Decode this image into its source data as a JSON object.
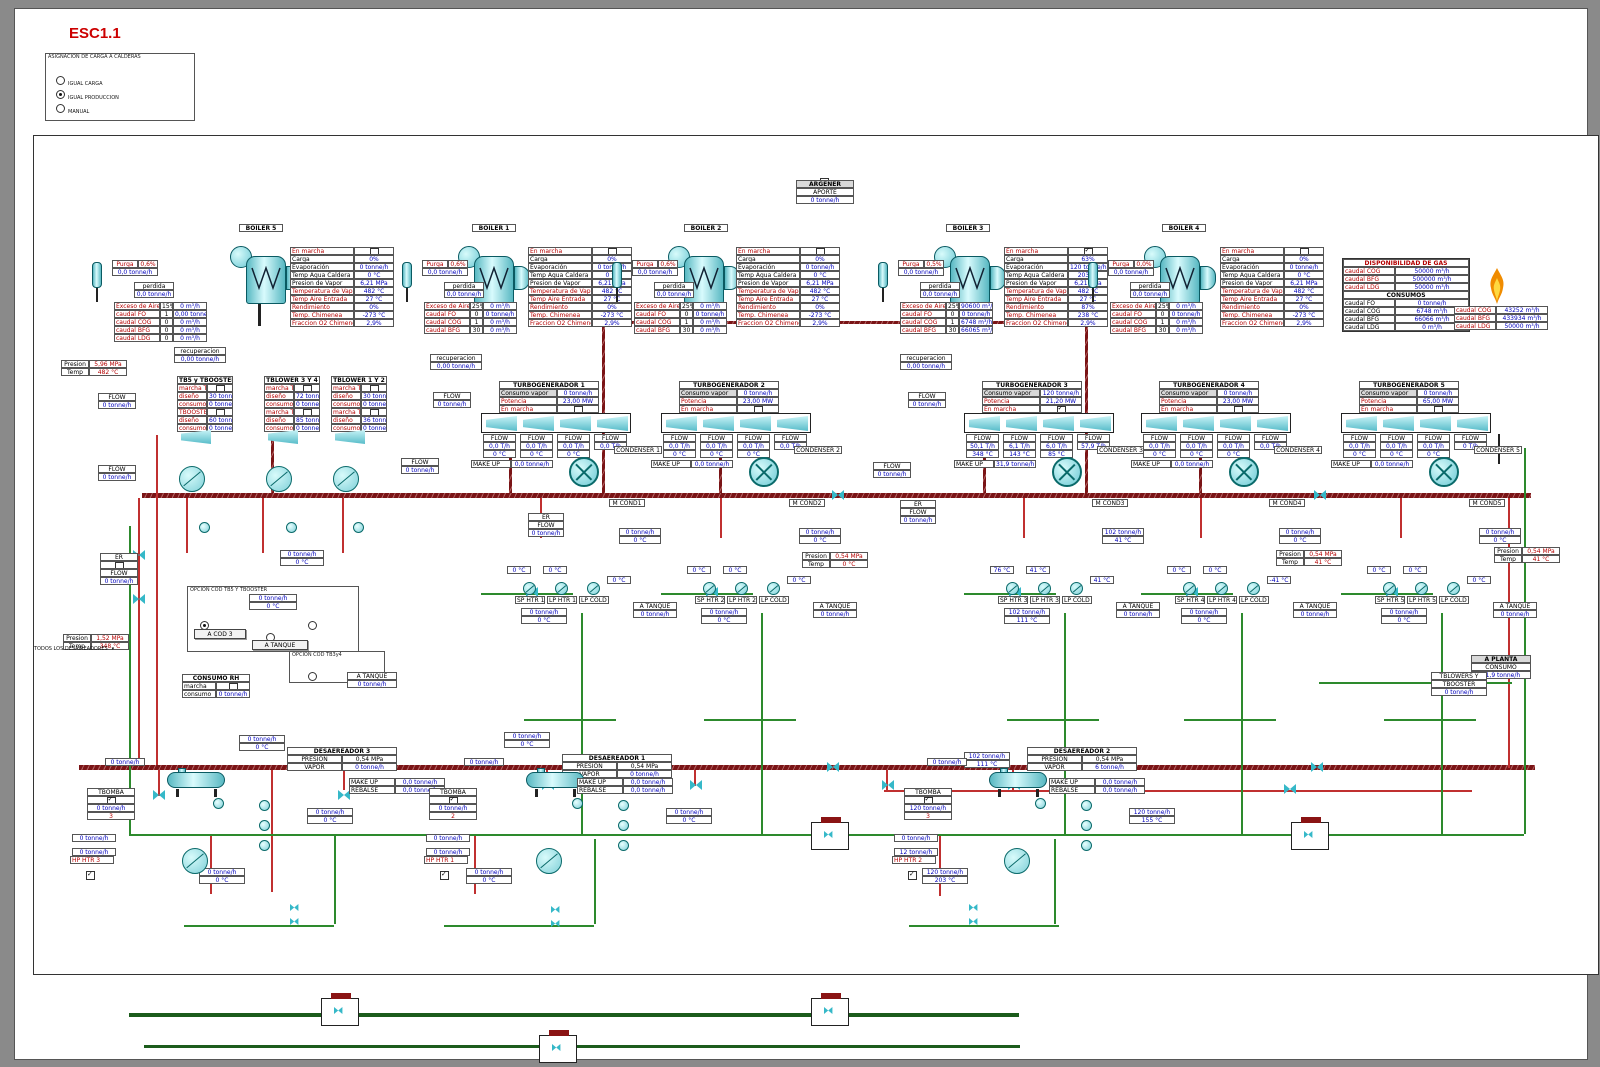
{
  "title": "ESC1.1",
  "assignment_panel": {
    "title": "ASIGNACION DE CARGA A CALDERAS",
    "options": [
      {
        "label": "IGUAL CARGA",
        "selected": false
      },
      {
        "label": "IGUAL PRODUCCION",
        "selected": true
      },
      {
        "label": "MANUAL",
        "selected": false
      }
    ]
  },
  "argener": {
    "title": "ARGENER",
    "row_label": "APORTE",
    "value": "0 tonne/h"
  },
  "gas_panel": {
    "title": "DISPONIBILIDAD DE GAS",
    "availability": [
      [
        "caudal COG",
        "50000 m³/h"
      ],
      [
        "caudal BFG",
        "500000 m³/h"
      ],
      [
        "caudal LDG",
        "50000 m³/h"
      ]
    ],
    "consumos_title": "CONSUMOS",
    "consumos": [
      [
        "caudal FO",
        "0 tonne/h"
      ],
      [
        "caudal COG",
        "6748 m³/h"
      ],
      [
        "caudal BFG",
        "66066 m³/h"
      ],
      [
        "caudal LDG",
        "0 m³/h"
      ]
    ]
  },
  "flare": {
    "rows": [
      [
        "caudal COG",
        "43252 m³/h"
      ],
      [
        "caudal BFG",
        "433934 m³/h"
      ],
      [
        "caudal LDG",
        "50000 m³/h"
      ]
    ]
  },
  "labels": {
    "presion": "Presion",
    "temp": "Temp",
    "flow": "FLOW",
    "er": "ER",
    "make_up": "MAKE UP",
    "rebalse": "REBALSE",
    "a_tanque": "A TANQUE",
    "tbomba": "TBOMBA",
    "purga": "Purga",
    "perdida": "perdida",
    "recuperacion": "recuperacion",
    "zero_flow": "0 tonne/h",
    "zero_flow2": "0,0 tonne/h",
    "zero_temp": "0 °C",
    "todos": "TODOS LOS DESAIREADORES",
    "consumo_vapor": "Consumo vapor",
    "potencia": "Potencia",
    "en_marcha": "En marcha",
    "presion_u": "PRESION",
    "vapor_u": "VAPOR"
  },
  "pressure_boxes": {
    "hp": [
      "5,96 MPa",
      "482 °C"
    ],
    "mp": [
      "1,52 MPa",
      "348 °C"
    ],
    "mid": [
      "0,54 MPa",
      "0 °C"
    ],
    "right1": [
      "0,54 MPa",
      "41 °C"
    ],
    "right2": [
      "0,54 MPa",
      "41 °C"
    ]
  },
  "a_planta": {
    "title": "A PLANTA",
    "row": "CONSUMO",
    "value": "31,9 tonne/h"
  },
  "tblowers_box": {
    "line1": "TBLOWERS Y",
    "line2": "TBOOSTER",
    "value": "0 tonne/h"
  },
  "consumo_rh": {
    "title": "CONSUMO RH",
    "row1": "marcha",
    "row2": "consumo",
    "value": "0 tonne/h"
  },
  "opcion1": {
    "title": "OPCION COD TB5 Y TBOOSTER",
    "value": "0 tonne/h",
    "temp": "0 °C",
    "btn1": "A COD 3",
    "btn2": "A TANQUE"
  },
  "opcion2": {
    "title": "OPCION COD TB3y4"
  },
  "tanque_small": {
    "label": "A TANQUE",
    "value": "0 tonne/h"
  },
  "blower_tables": [
    {
      "title": "TB5 y TBOOSTER",
      "rows": [
        [
          "marcha TB5",
          "cb"
        ],
        [
          "diseño",
          "30 tonne/h"
        ],
        [
          "consumo",
          "0 tonne/h"
        ],
        [
          "TBOOSTER",
          "cb"
        ],
        [
          "diseño",
          "60 tonne/h"
        ],
        [
          "consumo",
          "0 tonne/h"
        ]
      ]
    },
    {
      "title": "TBLOWER 3 Y 4",
      "rows": [
        [
          "marcha TB3",
          "cb"
        ],
        [
          "diseño",
          "72 tonne/h"
        ],
        [
          "consumo",
          "0 tonne/h"
        ],
        [
          "marcha TB4",
          "cb"
        ],
        [
          "diseño",
          "85 tonne/h"
        ],
        [
          "consumo",
          "0 tonne/h"
        ]
      ]
    },
    {
      "title": "TBLOWER 1 Y 2",
      "rows": [
        [
          "marcha TB1",
          "cb"
        ],
        [
          "diseño",
          "30 tonne/h"
        ],
        [
          "consumo",
          "0 tonne/h"
        ],
        [
          "marcha TB2",
          "cb"
        ],
        [
          "diseño",
          "36 tonne/h"
        ],
        [
          "consumo",
          "0 tonne/h"
        ]
      ]
    }
  ],
  "boilers": [
    {
      "label": "BOILER 5",
      "purga_pct": "0,6%",
      "purga_val": "0,0 tonne/h",
      "perdida": "0,0 tonne/h",
      "recuperacion": "0,00 tonne/h",
      "en_marcha": false,
      "fuel": [
        [
          "Exceso de Aire",
          "15%",
          "0 m³/h"
        ],
        [
          "caudal FO",
          "1",
          "0,00 tonne/h"
        ],
        [
          "caudal COG",
          "0",
          "0 m³/h"
        ],
        [
          "caudal BFG",
          "0",
          "0 m³/h"
        ],
        [
          "caudal LDG",
          "0",
          "0 m³/h"
        ]
      ],
      "status": [
        [
          "En marcha",
          "",
          1
        ],
        [
          "Carga",
          "0%",
          0
        ],
        [
          "Evaporación",
          "0 tonne/h",
          0
        ],
        [
          "Temp Agua Caldera",
          "0 °C",
          0
        ],
        [
          "Presion de Vapor",
          "6,21 MPa",
          0
        ],
        [
          "Temperatura de Vapor",
          "482 °C",
          1
        ],
        [
          "Temp Aire Entrada",
          "27 °C",
          1
        ],
        [
          "Rendimiento",
          "0%",
          1
        ],
        [
          "Temp. Chimenea",
          "-273 °C",
          1
        ],
        [
          "Fraccion O2 Chimenea",
          "2,9%",
          1
        ]
      ]
    },
    {
      "label": "BOILER 1",
      "purga_pct": "0,6%",
      "purga_val": "0,0 tonne/h",
      "perdida": "0,0 tonne/h",
      "recuperacion": "0,00 tonne/h",
      "en_marcha": false,
      "fuel": [
        [
          "Exceso de Aire",
          "25%",
          "0 m³/h"
        ],
        [
          "caudal FO",
          "0",
          "0 tonne/h"
        ],
        [
          "caudal COG",
          "1",
          "0 m³/h"
        ],
        [
          "caudal BFG",
          "30",
          "0 m³/h"
        ]
      ],
      "status": [
        [
          "En marcha",
          "",
          1
        ],
        [
          "Carga",
          "0%",
          0
        ],
        [
          "Evaporación",
          "0 tonne/h",
          0
        ],
        [
          "Temp Agua Caldera",
          "0 °C",
          0
        ],
        [
          "Presion de Vapor",
          "6,21 MPa",
          0
        ],
        [
          "Temperatura de Vapor",
          "482 °C",
          1
        ],
        [
          "Temp Aire Entrada",
          "27 °C",
          1
        ],
        [
          "Rendimiento",
          "0%",
          1
        ],
        [
          "Temp. Chimenea",
          "-273 °C",
          1
        ],
        [
          "Fraccion O2 Chimenea",
          "2,9%",
          1
        ]
      ]
    },
    {
      "label": "BOILER 2",
      "purga_pct": "0,6%",
      "purga_val": "0,0 tonne/h",
      "perdida": "0,0 tonne/h",
      "recuperacion": "",
      "en_marcha": false,
      "fuel": [
        [
          "Exceso de Aire",
          "25%",
          "0 m³/h"
        ],
        [
          "caudal FO",
          "0",
          "0 tonne/h"
        ],
        [
          "caudal COG",
          "1",
          "0 m³/h"
        ],
        [
          "caudal BFG",
          "30",
          "0 m³/h"
        ]
      ],
      "status": [
        [
          "En marcha",
          "",
          1
        ],
        [
          "Carga",
          "0%",
          0
        ],
        [
          "Evaporación",
          "0 tonne/h",
          0
        ],
        [
          "Temp Agua Caldera",
          "0 °C",
          0
        ],
        [
          "Presion de Vapor",
          "6,21 MPa",
          0
        ],
        [
          "Temperatura de Vapor",
          "482 °C",
          1
        ],
        [
          "Temp Aire Entrada",
          "27 °C",
          1
        ],
        [
          "Rendimiento",
          "0%",
          1
        ],
        [
          "Temp. Chimenea",
          "-273 °C",
          1
        ],
        [
          "Fraccion O2 Chimenea",
          "2,9%",
          1
        ]
      ]
    },
    {
      "label": "BOILER 3",
      "purga_pct": "0,5%",
      "purga_val": "0,0 tonne/h",
      "perdida": "0,0 tonne/h",
      "recuperacion": "0,00 tonne/h",
      "en_marcha": true,
      "fuel": [
        [
          "Exceso de Aire",
          "25%",
          "90600 m³/h"
        ],
        [
          "caudal FO",
          "0",
          "0 tonne/h"
        ],
        [
          "caudal COG",
          "1",
          "6748 m³/h"
        ],
        [
          "caudal BFG",
          "30",
          "66065 m³/h"
        ]
      ],
      "status": [
        [
          "En marcha",
          "",
          1
        ],
        [
          "Carga",
          "63%",
          0
        ],
        [
          "Evaporación",
          "120 tonne/h",
          0
        ],
        [
          "Temp Agua Caldera",
          "203 °C",
          0
        ],
        [
          "Presion de Vapor",
          "6,21 MPa",
          0
        ],
        [
          "Temperatura de Vapor",
          "482 °C",
          1
        ],
        [
          "Temp Aire Entrada",
          "27 °C",
          1
        ],
        [
          "Rendimiento",
          "87%",
          1
        ],
        [
          "Temp. Chimenea",
          "238 °C",
          1
        ],
        [
          "Fraccion O2 Chimenea",
          "2,9%",
          1
        ]
      ]
    },
    {
      "label": "BOILER 4",
      "purga_pct": "0,0%",
      "purga_val": "0,0 tonne/h",
      "perdida": "0,0 tonne/h",
      "recuperacion": "",
      "en_marcha": false,
      "fuel": [
        [
          "Exceso de Aire",
          "25%",
          "0 m³/h"
        ],
        [
          "caudal FO",
          "0",
          "0 tonne/h"
        ],
        [
          "caudal COG",
          "1",
          "0 m³/h"
        ],
        [
          "caudal BFG",
          "30",
          "0 m³/h"
        ]
      ],
      "status": [
        [
          "En marcha",
          "",
          1
        ],
        [
          "Carga",
          "0%",
          0
        ],
        [
          "Evaporación",
          "0 tonne/h",
          0
        ],
        [
          "Temp Agua Caldera",
          "0 °C",
          0
        ],
        [
          "Presion de Vapor",
          "6,21 MPa",
          0
        ],
        [
          "Temperatura de Vapor",
          "482 °C",
          1
        ],
        [
          "Temp Aire Entrada",
          "27 °C",
          1
        ],
        [
          "Rendimiento",
          "0%",
          1
        ],
        [
          "Temp. Chimenea",
          "-273 °C",
          1
        ],
        [
          "Fraccion O2 Chimenea",
          "2,9%",
          1
        ]
      ]
    }
  ],
  "turbogenerators": [
    {
      "label": "TURBOGENERADOR 1",
      "consumo": "0 tonne/h",
      "potencia": "23,00 MW",
      "en_marcha": false,
      "flows": [
        [
          "0,0 T/h",
          "0 °C"
        ],
        [
          "0,0 T/h",
          "0 °C"
        ],
        [
          "0,0 T/h",
          "0 °C"
        ],
        [
          "0,0 T/h",
          ""
        ]
      ],
      "makeup": "0,0 tonne/h",
      "condenser": "CONDENSER 1",
      "mcond": "M COND1",
      "heaters": [
        "SP HTR 1",
        "LP HTR 1",
        "LP COLD 1"
      ],
      "temps": [
        "0 °C",
        "0 °C",
        "0 °C"
      ],
      "below": [
        "0 tonne/h",
        "0 °C"
      ],
      "bottom": [
        "0 tonne/h",
        "0 °C"
      ],
      "tanque_val": "0 tonne/h"
    },
    {
      "label": "TURBOGENERADOR 2",
      "consumo": "0 tonne/h",
      "potencia": "23,00 MW",
      "en_marcha": false,
      "flows": [
        [
          "0,0 T/h",
          "0 °C"
        ],
        [
          "0,0 T/h",
          "0 °C"
        ],
        [
          "0,0 T/h",
          "0 °C"
        ],
        [
          "0,0 T/h",
          ""
        ]
      ],
      "makeup": "0,0 tonne/h",
      "condenser": "CONDENSER 2",
      "mcond": "M COND2",
      "heaters": [
        "SP HTR 2",
        "LP HTR 2",
        "LP COLD 2"
      ],
      "temps": [
        "0 °C",
        "0 °C",
        "0 °C"
      ],
      "below": [
        "0 tonne/h",
        "0 °C"
      ],
      "bottom": [
        "0 tonne/h",
        "0 °C"
      ],
      "tanque_val": "0 tonne/h"
    },
    {
      "label": "TURBOGENERADOR 3",
      "consumo": "120 tonne/h",
      "potencia": "21,20 MW",
      "en_marcha": true,
      "flows": [
        [
          "50,1 T/h",
          "348 °C"
        ],
        [
          "6,1 T/h",
          "143 °C"
        ],
        [
          "6,0 T/h",
          "85 °C"
        ],
        [
          "57,9 T/h",
          ""
        ]
      ],
      "makeup": "31,9 tonne/h",
      "condenser": "CONDENSER 3",
      "mcond": "M COND3",
      "heaters": [
        "SP HTR 3",
        "LP HTR 3",
        "LP COLD 3"
      ],
      "temps": [
        "76 °C",
        "41 °C",
        "41 °C"
      ],
      "below": [
        "102 tonne/h",
        "41 °C"
      ],
      "bottom": [
        "102 tonne/h",
        "111 °C"
      ],
      "tanque_val": "0 tonne/h"
    },
    {
      "label": "TURBOGENERADOR 4",
      "consumo": "0 tonne/h",
      "potencia": "23,00 MW",
      "en_marcha": false,
      "flows": [
        [
          "0,0 T/h",
          "0 °C"
        ],
        [
          "0,0 T/h",
          "0 °C"
        ],
        [
          "0,0 T/h",
          "0 °C"
        ],
        [
          "0,0 T/h",
          ""
        ]
      ],
      "makeup": "0,0 tonne/h",
      "condenser": "CONDENSER 4",
      "mcond": "M COND4",
      "heaters": [
        "SP HTR 4",
        "LP HTR 4",
        "LP COLD 4"
      ],
      "temps": [
        "0 °C",
        "0 °C",
        "-41 °C"
      ],
      "below": [
        "0 tonne/h",
        "0 °C"
      ],
      "bottom": [
        "0 tonne/h",
        "0 °C"
      ],
      "tanque_val": "0 tonne/h"
    },
    {
      "label": "TURBOGENERADOR 5",
      "consumo": "0 tonne/h",
      "potencia": "65,00 MW",
      "en_marcha": false,
      "flows": [
        [
          "0,0 T/h",
          "0 °C"
        ],
        [
          "0,0 T/h",
          "0 °C"
        ],
        [
          "0,0 T/h",
          "0 °C"
        ],
        [
          "0 T/h",
          ""
        ]
      ],
      "makeup": "0,0 tonne/h",
      "condenser": "CONDENSER 5",
      "mcond": "M COND5",
      "heaters": [
        "SP HTR 5",
        "LP HTR 5",
        "LP COLD 5"
      ],
      "temps": [
        "0 °C",
        "0 °C",
        "0 °C"
      ],
      "below": [
        "0 tonne/h",
        "0 °C"
      ],
      "bottom": [
        "0 tonne/h",
        "0 °C"
      ],
      "tanque_val": "0 tonne/h"
    }
  ],
  "deaerators": [
    {
      "title": "DESAEREADOR 3",
      "presion": "0,54 MPa",
      "vapor": "0 tonne/h",
      "make_up": "0,0 tonne/h",
      "rebalse": "0,0 tonne/h",
      "tbomba_flow": "0 tonne/h",
      "tbomba_num": "3",
      "tbomba_on": true,
      "hp_label": "HP HTR 3",
      "hp_on": true,
      "top": [
        "0 tonne/h",
        "0 °C"
      ],
      "mid": [
        "0 tonne/h",
        "0 °C"
      ],
      "low": "0 tonne/h",
      "low2": "0 tonne/h",
      "bottom": [
        "0 tonne/h",
        "0 °C"
      ],
      "feed": "0 tonne/h"
    },
    {
      "title": "DESAEREADOR 1",
      "presion": "0,54 MPa",
      "vapor": "0 tonne/h",
      "make_up": "0,0 tonne/h",
      "rebalse": "0,0 tonne/h",
      "tbomba_flow": "0 tonne/h",
      "tbomba_num": "2",
      "tbomba_on": true,
      "hp_label": "HP HTR 1",
      "hp_on": true,
      "top": [
        "0 tonne/h",
        "0 °C"
      ],
      "mid": [
        "0 tonne/h",
        "0 °C"
      ],
      "low": "0 tonne/h",
      "low2": "0 tonne/h",
      "bottom": [
        "0 tonne/h",
        "0 °C"
      ],
      "feed": "0 tonne/h"
    },
    {
      "title": "DESAEREADOR 2",
      "presion": "0,54 MPa",
      "vapor": "6 tonne/h",
      "make_up": "0,0 tonne/h",
      "rebalse": "0,0 tonne/h",
      "tbomba_flow": "120 tonne/h",
      "tbomba_num": "3",
      "tbomba_on": true,
      "hp_label": "HP HTR 2",
      "hp_on": true,
      "top": [
        "102 tonne/h",
        "111 °C"
      ],
      "mid": [
        "120 tonne/h",
        "155 °C"
      ],
      "low": "12 tonne/h",
      "low2": "0 tonne/h",
      "bottom": [
        "120 tonne/h",
        "203 °C"
      ],
      "feed": "0 tonne/h"
    }
  ]
}
